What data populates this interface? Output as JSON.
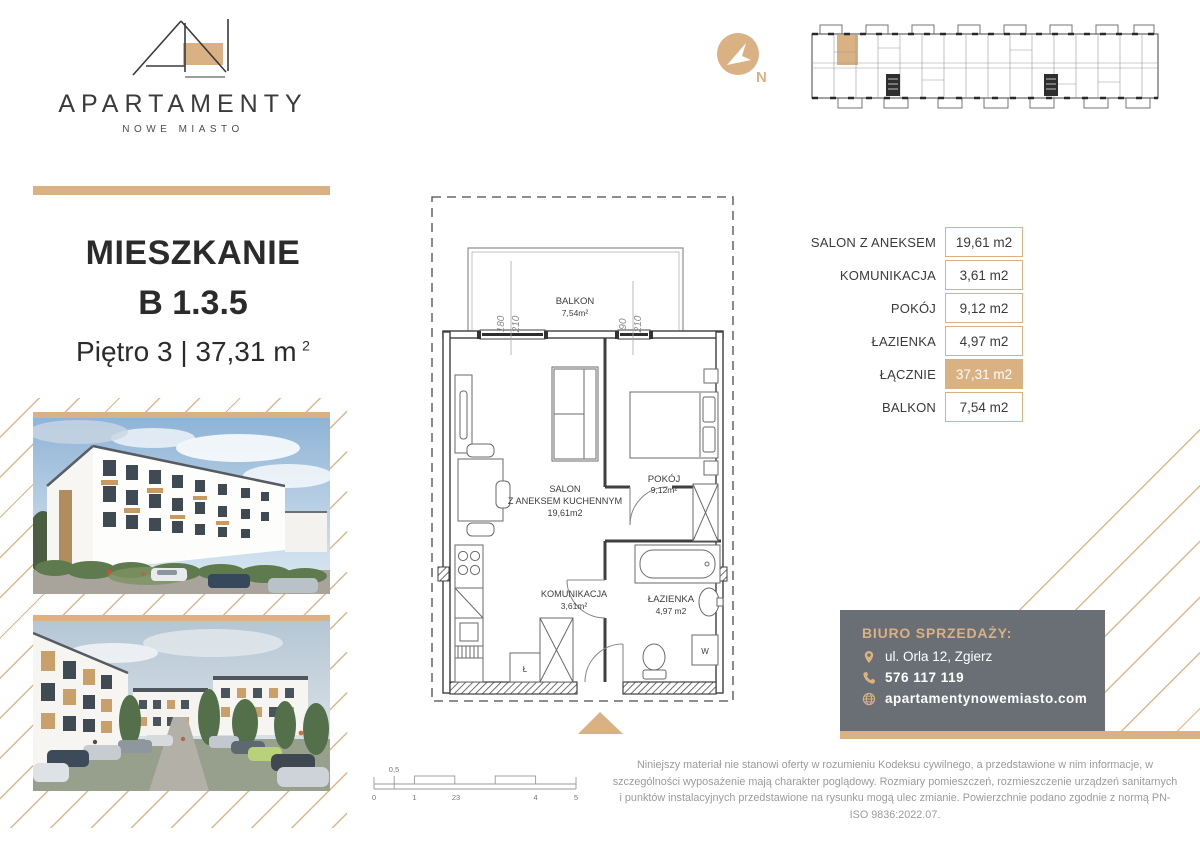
{
  "brand": {
    "title": "APARTAMENTY",
    "subtitle": "NOWE MIASTO"
  },
  "apartment": {
    "label": "MIESZKANIE",
    "number": "B 1.3.5",
    "floor": "Piętro 3 | 37,31 m",
    "floor_sup": "2"
  },
  "compass": {
    "north": "N"
  },
  "area_table": {
    "rows": [
      {
        "label": "SALON Z ANEKSEM",
        "value": "19,61 m2"
      },
      {
        "label": "KOMUNIKACJA",
        "value": "3,61 m2"
      },
      {
        "label": "POKÓJ",
        "value": "9,12 m2"
      },
      {
        "label": "ŁAZIENKA",
        "value": "4,97 m2"
      },
      {
        "label": "ŁĄCZNIE",
        "value": "37,31 m2"
      },
      {
        "label": "BALKON",
        "value": "7,54 m2"
      }
    ]
  },
  "floorplan": {
    "balkon_name": "BALKON",
    "balkon_area": "7,54m²",
    "salon_l1": "SALON",
    "salon_l2": "Z ANEKSEM KUCHENNYM",
    "salon_area": "19,61m2",
    "pokoj_name": "POKÓJ",
    "pokoj_area": "9,12m²",
    "komunikacja_name": "KOMUNIKACJA",
    "komunikacja_area": "3,61m²",
    "lazienka_name": "ŁAZIENKA",
    "lazienka_area": "4,97 m2",
    "washer_label": "W",
    "fridge_label": "Ł",
    "dim_win1_width": "180",
    "dim_win1_height": "210",
    "dim_win2_width": "90",
    "dim_win2_height": "210"
  },
  "scalebar": {
    "t0": "0",
    "t05": "0,5",
    "t1": "1",
    "t23": "23",
    "t4": "4",
    "t5": "5"
  },
  "sales_office": {
    "heading": "BIURO SPRZEDAŻY:",
    "address": "ul. Orla 12, Zgierz",
    "phone": "576 117 119",
    "website": "apartamentynowemiasto.com"
  },
  "disclaimer": "Niniejszy materiał nie stanowi oferty w rozumieniu Kodeksu cywilnego, a przedstawione w nim informacje, w szczególności wyposażenie mają charakter poglądowy. Rozmiary pomieszczeń, rozmieszczenie urządzeń sanitarnych i punktów instalacyjnych przedstawione na rysunku mogą ulec zmianie. Powierzchnie podano zgodnie z normą PN-ISO 9836:2022.07.",
  "colors": {
    "gold": "#D9B183",
    "gray_box": "#6A6F75",
    "dark_text": "#2D2D2D",
    "plan_line": "#4A4A4A"
  }
}
